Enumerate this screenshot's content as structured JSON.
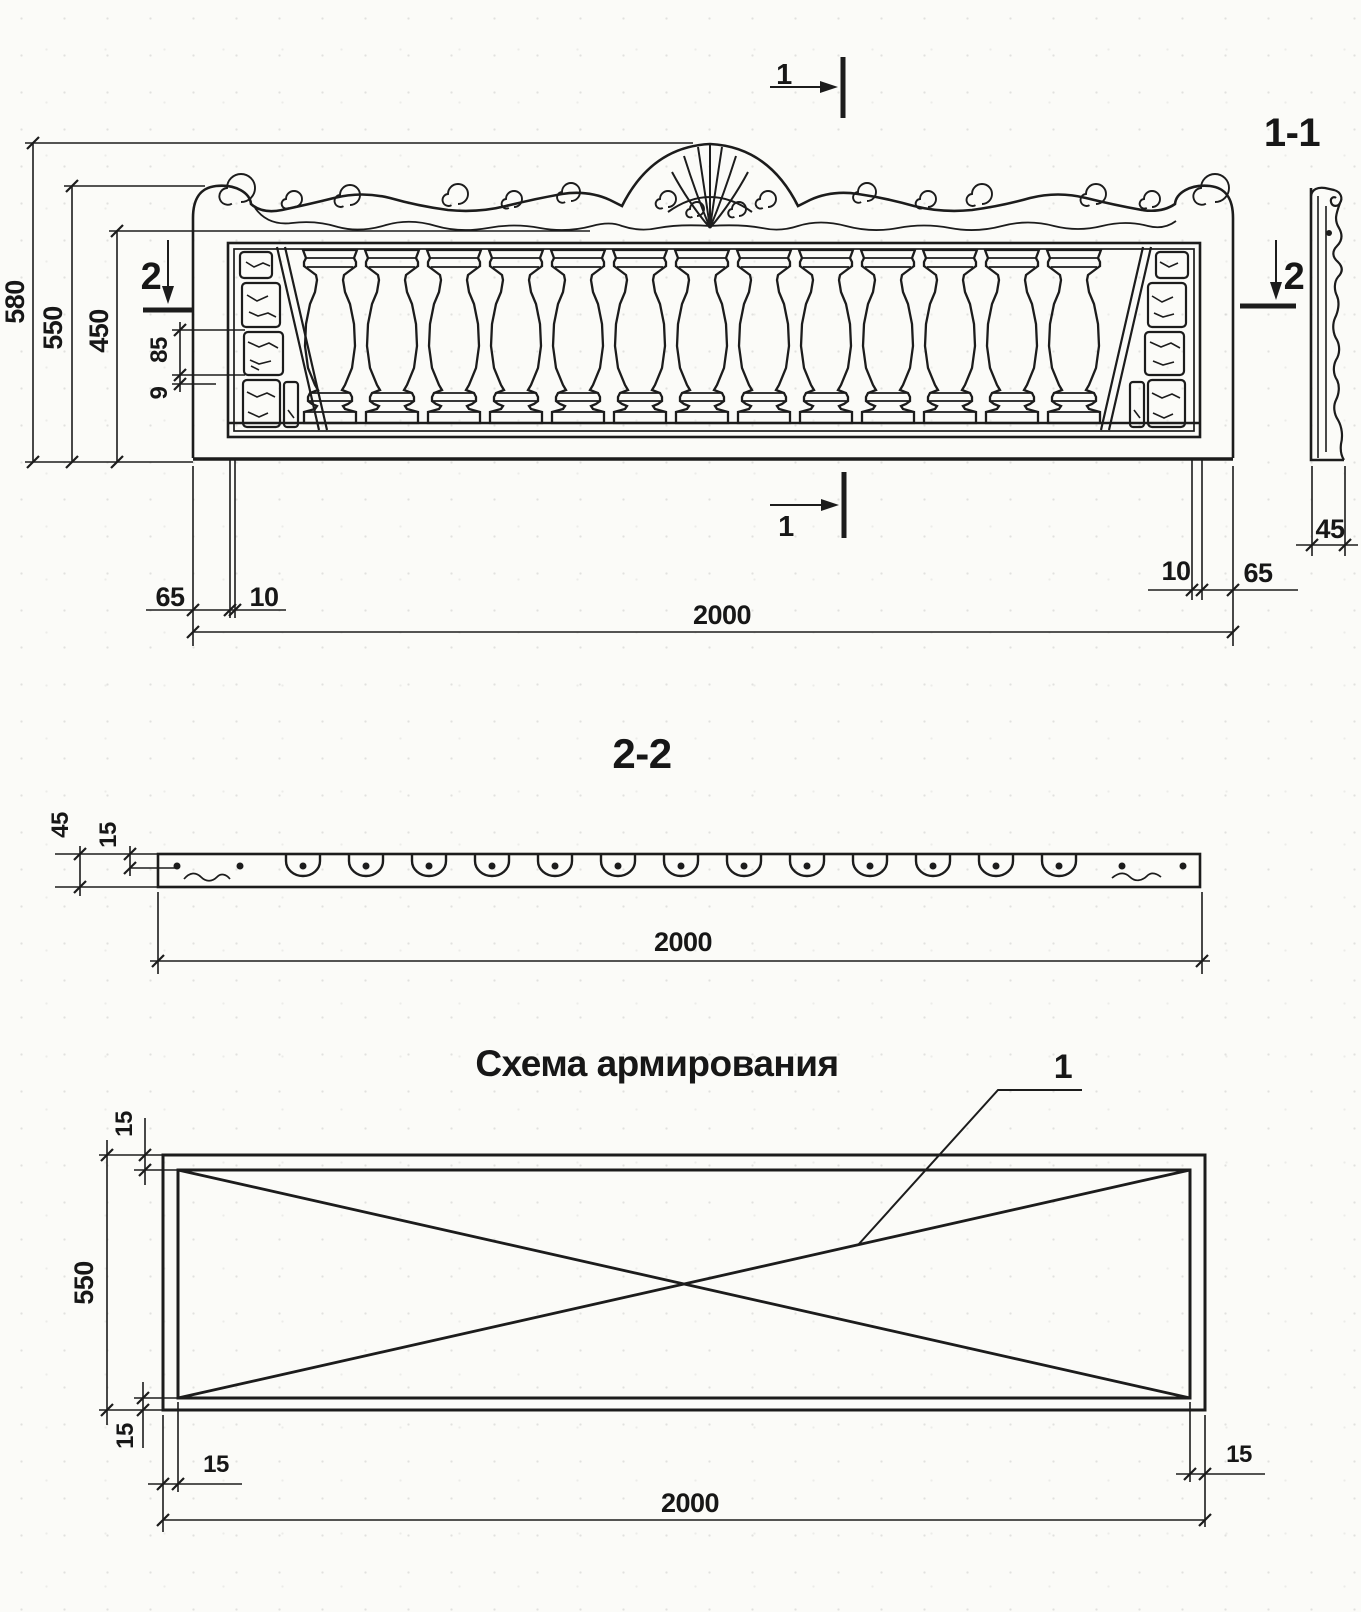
{
  "drawing": {
    "front_view": {
      "section_cut_1_top_label": "1",
      "section_cut_1_bottom_label": "1",
      "section_cut_2_left_label": "2",
      "section_cut_2_right_label": "2",
      "dim_total_height": "580",
      "dim_panel_height": "550",
      "dim_opening_height": "450",
      "dim_inset_85": "85",
      "dim_inset_9": "9",
      "dim_left_end": "65",
      "dim_left_gap": "10",
      "dim_length": "2000",
      "dim_right_gap": "10",
      "dim_right_end": "65",
      "baluster_count": 13
    },
    "section_1_1": {
      "label": "1-1",
      "dim_thickness": "45"
    },
    "section_2_2": {
      "label": "2-2",
      "dim_thickness": "45",
      "dim_rebar_cover": "15",
      "dim_length": "2000",
      "pocket_count": 13
    },
    "reinforcement_schema": {
      "title": "Схема армирования",
      "rebar_item_label": "1",
      "dim_cover_top": "15",
      "dim_height": "550",
      "dim_cover_bottom": "15",
      "dim_cover_left": "15",
      "dim_length": "2000",
      "dim_cover_right": "15"
    }
  },
  "colors": {
    "ink": "#1c1c1c",
    "paper": "#fbfbf8"
  }
}
